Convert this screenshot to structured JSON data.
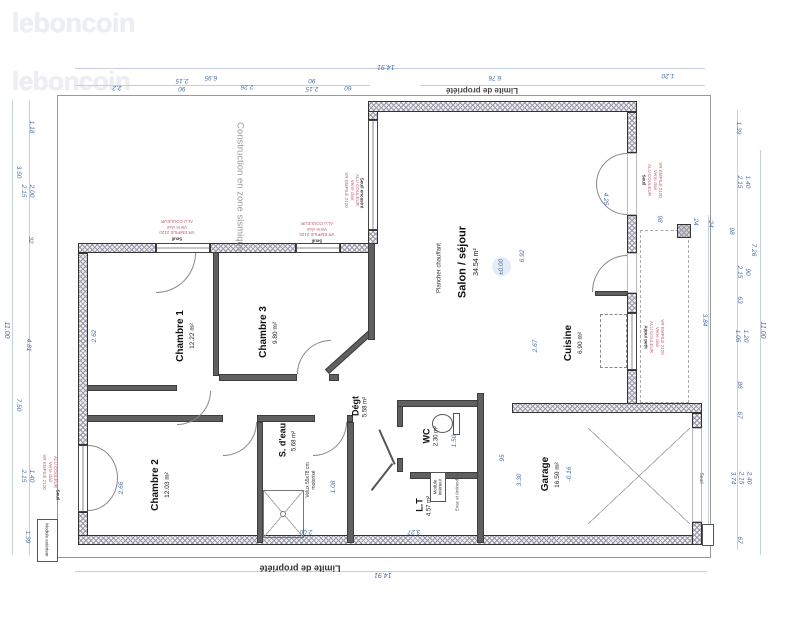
{
  "watermarks": {
    "logo_top": "leboncoin",
    "logo_bottom": "leboncoin"
  },
  "site": {
    "limite_top": "Limite de propriété",
    "limite_bottom": "Limite de propriété",
    "seismic_note": "Construction en zone sismique"
  },
  "rooms": {
    "chambre1": {
      "name": "Chambre 1",
      "area": "12.22 m²"
    },
    "chambre3": {
      "name": "Chambre 3",
      "area": "9.80 m²"
    },
    "chambre2": {
      "name": "Chambre 2",
      "area": "12.03 m²"
    },
    "salon": {
      "name": "Salon / séjour",
      "area": "34.54 m²",
      "floor_note": "Plancher chauffant",
      "level": "±0.00"
    },
    "cuisine": {
      "name": "Cuisine",
      "area": "6.90 m²"
    },
    "garage": {
      "name": "Garage",
      "area": "16.50 m²",
      "level": "-0.16"
    },
    "wc": {
      "name": "WC",
      "area": "2.30 m²"
    },
    "sdeau": {
      "name": "S. d'eau",
      "area": "5.68 m²"
    },
    "degagement": {
      "name": "Dégt",
      "area": "5.58 m²"
    },
    "lt": {
      "name": "L.T",
      "area": "4.57 m²"
    }
  },
  "equipment": {
    "velux": "Velux 55x78 cm\nmotorisé",
    "module_interieur": "Module\nintérieur",
    "module_exterieur": "Module extérieur",
    "evac": "Evac et Arr/module"
  },
  "window_specs": {
    "spec_alu": "ALU COULEUR\nVerre clair\nVR EMPILÉ 2120",
    "spec_vr": "VR EMPILÉ 2120\nVerre clair\nALU COULEUR",
    "appui": "Appui petit",
    "seuil": "Seuil",
    "seuil_encastre": "Seuil encastré"
  },
  "dimensions": {
    "top": [
      "14.91",
      "2.2",
      "90\n2.15",
      "6.95",
      "2.26",
      "2.15\n90",
      "60",
      "6.76",
      "1.20"
    ],
    "bottom": [
      "14.91"
    ],
    "left": [
      "1.18",
      "3.50",
      "2.00\n2.15",
      "32",
      "11.00",
      "4.81",
      "7.50",
      "1.40\n2.15",
      "1.39"
    ],
    "right": [
      "1.39",
      "1.40\n2.15",
      "24",
      "98",
      "7.26",
      "90\n2.15",
      "63",
      "3.84",
      "1.20\n1.05",
      "11.00",
      "86",
      "67",
      "2.40\n2.15\n3.74",
      "67"
    ],
    "inner": [
      "6.92",
      "2.67",
      "3.30",
      "2.62",
      "2.66",
      "1.08",
      "2.00",
      "3.27",
      "95",
      "1.50",
      "4.25",
      "98",
      "24"
    ]
  },
  "colors": {
    "dimension_blue": "#4a6fa8",
    "annotation_red": "#c0606d",
    "wall_dark": "#3d3d3d"
  }
}
